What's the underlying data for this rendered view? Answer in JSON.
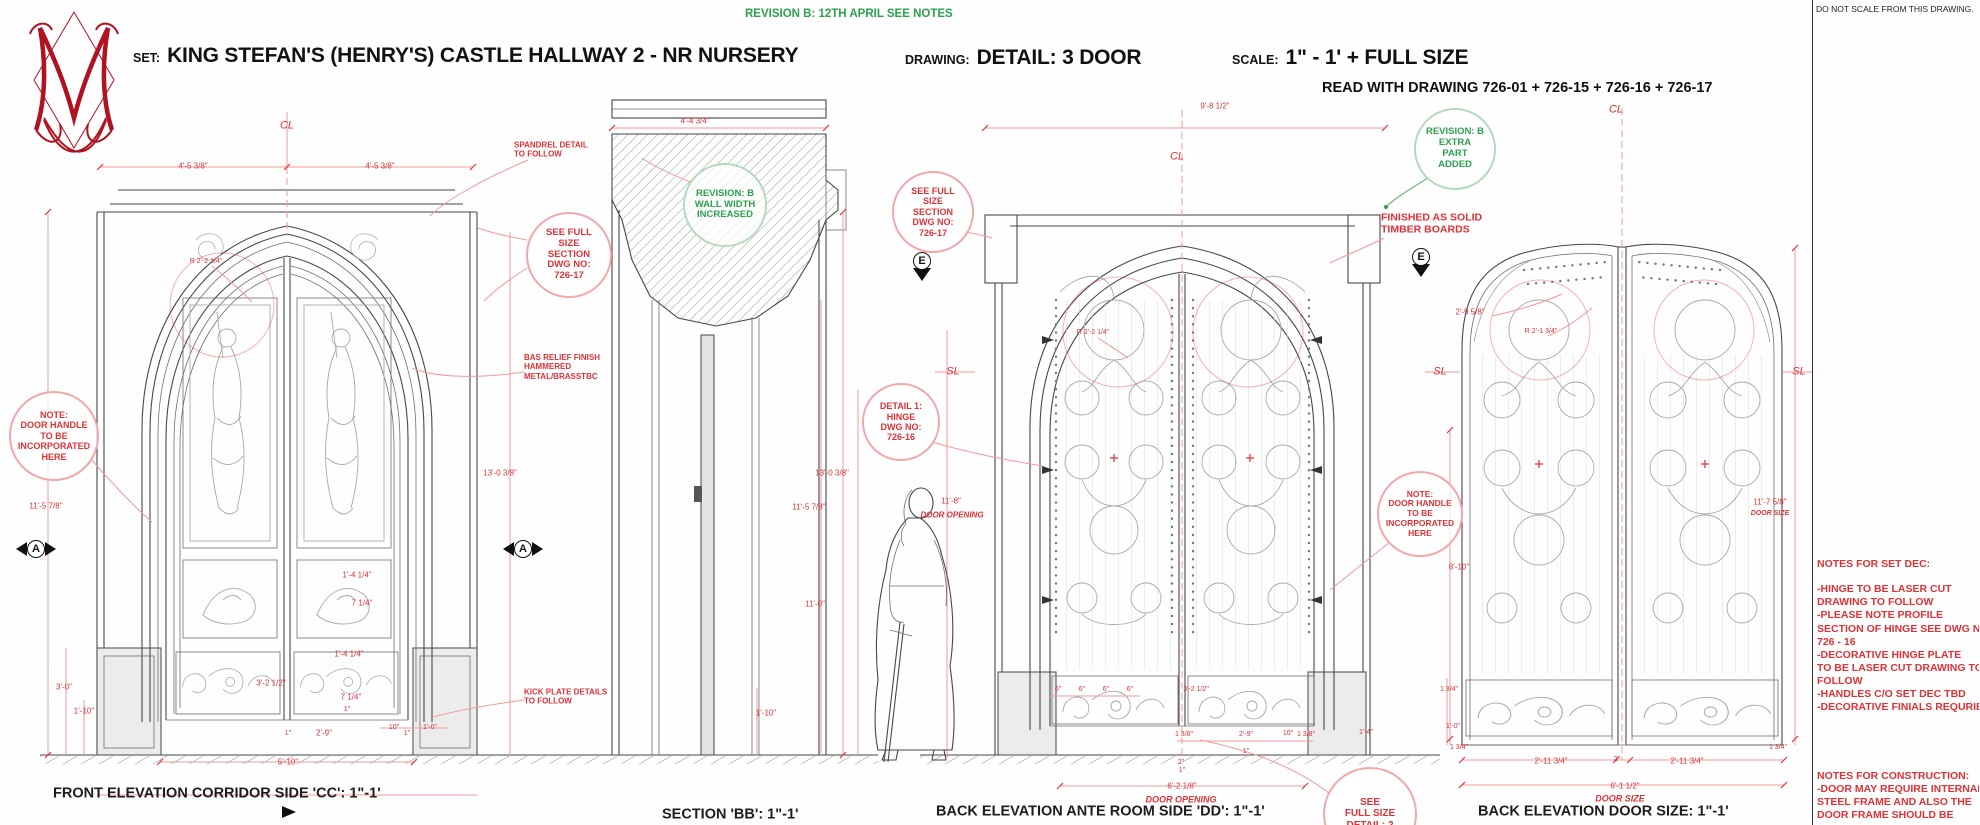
{
  "colors": {
    "red": "#de3237",
    "red_soft": "#f2a7a9",
    "green": "#2aa34c",
    "green_soft": "#b4dabb",
    "black": "#1d1d1d",
    "ink": "#474747"
  },
  "header": {
    "revision_note": "REVISION B: 12TH APRIL SEE NOTES",
    "set_label": "SET:",
    "set_value": "KING STEFAN'S (HENRY'S) CASTLE  HALLWAY 2 - NR NURSERY",
    "drawing_label": "DRAWING:",
    "drawing_value": "DETAIL: 3 DOOR",
    "scale_label": "SCALE:",
    "scale_value": "1\" - 1' + FULL SIZE",
    "read_with": "READ WITH DRAWING 726-01 + 726-15 + 726-16 + 726-17"
  },
  "logo": {
    "letter": "M"
  },
  "captions": [
    {
      "n": "do-not-scale-note",
      "t": "DO NOT SCALE FROM THIS DRAWING.",
      "x": 1816,
      "y": 9,
      "fs": 8.5,
      "c": "k",
      "al": "l"
    },
    {
      "n": "caption-front-elevation",
      "t": "FRONT ELEVATION CORRIDOR SIDE 'CC': 1\"-1'",
      "x": 53,
      "y": 794,
      "fs": 14.5,
      "c": "k",
      "b": 1,
      "al": "l"
    },
    {
      "n": "caption-section-bb",
      "t": "SECTION 'BB': 1\"-1'",
      "x": 662,
      "y": 815,
      "fs": 14.5,
      "c": "k",
      "b": 1,
      "al": "l"
    },
    {
      "n": "caption-back-elevation-dd",
      "t": "BACK ELEVATION ANTE ROOM SIDE 'DD': 1\"-1'",
      "x": 936,
      "y": 812,
      "fs": 14.5,
      "c": "k",
      "b": 1,
      "al": "l"
    },
    {
      "n": "caption-back-elevation-door-size",
      "t": "BACK ELEVATION DOOR SIZE: 1\"-1'",
      "x": 1478,
      "y": 812,
      "fs": 14.5,
      "c": "k",
      "b": 1,
      "al": "l"
    }
  ],
  "labels": [
    {
      "t": "CL",
      "x": 287,
      "y": 126,
      "fs": 11,
      "i": 1
    },
    {
      "t": "4'-5 3/8\"",
      "x": 193,
      "y": 166
    },
    {
      "t": "4'-5 3/8\"",
      "x": 380,
      "y": 166
    },
    {
      "n": "spandrel-note",
      "t": "SPANDREL DETAIL\nTO FOLLOW",
      "x": 514,
      "y": 150,
      "b": 1,
      "al": "l"
    },
    {
      "t": "R 2'-2 1/4\"",
      "x": 206,
      "y": 262,
      "fs": 7
    },
    {
      "t": "11'-5 7/8\"",
      "x": 46,
      "y": 506
    },
    {
      "t": "3'-0\"",
      "x": 64,
      "y": 687
    },
    {
      "t": "1'-10\"",
      "x": 84,
      "y": 711
    },
    {
      "t": "3'-2 1/2\"",
      "x": 271,
      "y": 683
    },
    {
      "t": "1'-4 1/4\"",
      "x": 349,
      "y": 654
    },
    {
      "t": "7 1/4\"",
      "x": 351,
      "y": 697
    },
    {
      "t": "1'-4 1/4\"",
      "x": 357,
      "y": 575
    },
    {
      "t": "7 1/4\"",
      "x": 362,
      "y": 603
    },
    {
      "t": "1\"",
      "x": 347,
      "y": 710,
      "fs": 7
    },
    {
      "t": "2'-9\"",
      "x": 324,
      "y": 733
    },
    {
      "t": "10\"",
      "x": 394,
      "y": 728,
      "fs": 7
    },
    {
      "t": "1'-0\"",
      "x": 430,
      "y": 728,
      "fs": 7
    },
    {
      "t": "1\"",
      "x": 288,
      "y": 734,
      "fs": 7
    },
    {
      "t": "1\"",
      "x": 407,
      "y": 734,
      "fs": 7
    },
    {
      "t": "5'-10\"",
      "x": 288,
      "y": 762
    },
    {
      "t": "13'-0 3/8\"",
      "x": 500,
      "y": 473
    },
    {
      "n": "bas-relief-note",
      "t": "BAS RELIEF FINISH\nHAMMERED\nMETAL/BRASSTBC",
      "x": 524,
      "y": 367,
      "b": 1,
      "al": "l"
    },
    {
      "n": "kick-plate-note",
      "t": "KICK PLATE DETAILS\nTO FOLLOW",
      "x": 524,
      "y": 697,
      "b": 1,
      "al": "l"
    },
    {
      "t": "4'-4 3/4\"",
      "x": 695,
      "y": 121
    },
    {
      "t": "13'-0 3/8\"",
      "x": 832,
      "y": 473
    },
    {
      "t": "11'-5 7/8\"",
      "x": 809,
      "y": 507
    },
    {
      "t": "11'-0\"",
      "x": 815,
      "y": 604
    },
    {
      "t": "1'-10\"",
      "x": 766,
      "y": 713
    },
    {
      "t": "9'-8 1/2\"",
      "x": 1215,
      "y": 106
    },
    {
      "t": "CL",
      "x": 1177,
      "y": 157,
      "fs": 11,
      "i": 1
    },
    {
      "t": "CL",
      "x": 1616,
      "y": 110,
      "fs": 11,
      "i": 1
    },
    {
      "t": "SL",
      "x": 953,
      "y": 372,
      "fs": 11,
      "i": 1
    },
    {
      "t": "SL",
      "x": 1440,
      "y": 372,
      "fs": 11,
      "i": 1
    },
    {
      "t": "SL",
      "x": 1799,
      "y": 372,
      "fs": 11,
      "i": 1
    },
    {
      "t": "R 2'-2 1/4\"",
      "x": 1093,
      "y": 333,
      "fs": 7
    },
    {
      "t": "R 2'-1 3/4\"",
      "x": 1541,
      "y": 332,
      "fs": 7
    },
    {
      "t": "11'-8\"",
      "x": 951,
      "y": 501
    },
    {
      "t": "DOOR OPENING",
      "x": 952,
      "y": 515,
      "i": 1,
      "b": 1
    },
    {
      "n": "timber-boards-note",
      "t": "FINISHED AS SOLID\nTIMBER BOARDS",
      "x": 1381,
      "y": 224,
      "fs": 10.5,
      "b": 1,
      "al": "l"
    },
    {
      "t": "6\"",
      "x": 1058,
      "y": 690,
      "fs": 7
    },
    {
      "t": "6\"",
      "x": 1082,
      "y": 690,
      "fs": 7
    },
    {
      "t": "6\"",
      "x": 1106,
      "y": 690,
      "fs": 7
    },
    {
      "t": "6\"",
      "x": 1130,
      "y": 690,
      "fs": 7
    },
    {
      "t": "3'-2 1/2\"",
      "x": 1196,
      "y": 690,
      "fs": 7
    },
    {
      "t": "1 3/8\"",
      "x": 1184,
      "y": 735,
      "fs": 7
    },
    {
      "t": "2'-9\"",
      "x": 1246,
      "y": 735,
      "fs": 7
    },
    {
      "t": "10\"",
      "x": 1288,
      "y": 734,
      "fs": 7
    },
    {
      "t": "1 3/8\"",
      "x": 1306,
      "y": 735,
      "fs": 7
    },
    {
      "t": "1\"",
      "x": 1246,
      "y": 752,
      "fs": 7
    },
    {
      "t": "2\"",
      "x": 1181,
      "y": 763,
      "fs": 7
    },
    {
      "t": "1\"",
      "x": 1182,
      "y": 771,
      "fs": 7
    },
    {
      "t": "6'-2 1/8\"",
      "x": 1182,
      "y": 786
    },
    {
      "t": "DOOR OPENING",
      "x": 1181,
      "y": 800,
      "fs": 9,
      "i": 1,
      "b": 1
    },
    {
      "t": "1'-4\"",
      "x": 1366,
      "y": 733,
      "fs": 7
    },
    {
      "t": "2'-9 5/8\"",
      "x": 1470,
      "y": 312
    },
    {
      "t": "8'-10\"",
      "x": 1459,
      "y": 567
    },
    {
      "t": "11'-7 5/8\"",
      "x": 1770,
      "y": 502
    },
    {
      "t": "DOOR SIZE",
      "x": 1770,
      "y": 514,
      "fs": 7,
      "i": 1,
      "b": 1
    },
    {
      "t": "1 3/4\"",
      "x": 1449,
      "y": 690,
      "fs": 7
    },
    {
      "t": "1'-0\"",
      "x": 1453,
      "y": 727,
      "fs": 7
    },
    {
      "t": "1 3/4\"",
      "x": 1459,
      "y": 748,
      "fs": 7
    },
    {
      "t": "1 3/4\"",
      "x": 1778,
      "y": 748,
      "fs": 7
    },
    {
      "t": "2'-11 3/4\"",
      "x": 1551,
      "y": 761
    },
    {
      "t": "2\"",
      "x": 1617,
      "y": 760,
      "fs": 7
    },
    {
      "t": "2'-11 3/4\"",
      "x": 1687,
      "y": 761
    },
    {
      "t": "6'-1 1/2\"",
      "x": 1625,
      "y": 786
    },
    {
      "t": "DOOR SIZE",
      "x": 1620,
      "y": 799,
      "fs": 9,
      "i": 1,
      "b": 1
    }
  ],
  "bubbles": [
    {
      "n": "see-full-size-section-bubble",
      "x": 567,
      "y": 253,
      "r": 41,
      "c": "red",
      "fs": 9.5,
      "t": "SEE FULL\nSIZE\nSECTION\nDWG NO:\n726-17"
    },
    {
      "n": "revision-wall-width-bubble",
      "x": 723,
      "y": 203,
      "r": 40,
      "c": "green",
      "fs": 9.5,
      "t": "REVISION: B\nWALL WIDTH\nINCREASED"
    },
    {
      "n": "door-handle-note-bubble-left",
      "x": 52,
      "y": 434,
      "r": 43,
      "c": "red",
      "fs": 9,
      "t": "NOTE:\nDOOR HANDLE\nTO BE\nINCORPORATED\nHERE"
    },
    {
      "n": "see-full-size-section-bubble-2",
      "x": 931,
      "y": 210,
      "r": 39,
      "c": "red",
      "fs": 9,
      "t": "SEE FULL\nSIZE\nSECTION\nDWG NO:\n726-17"
    },
    {
      "n": "detail-1-hinge-bubble",
      "x": 899,
      "y": 420,
      "r": 37,
      "c": "red",
      "fs": 9,
      "t": "DETAIL 1:\nHINGE\nDWG NO:\n726-16"
    },
    {
      "n": "revision-extra-part-bubble",
      "x": 1453,
      "y": 147,
      "r": 39,
      "c": "green",
      "fs": 9.5,
      "t": "REVISION: B\nEXTRA\nPART\nADDED"
    },
    {
      "n": "door-handle-note-bubble-right",
      "x": 1418,
      "y": 512,
      "r": 41,
      "c": "red",
      "fs": 8.5,
      "t": "NOTE:\nDOOR HANDLE\nTO BE\nINCORPORATED\nHERE"
    },
    {
      "n": "see-full-size-detail-2-bubble",
      "x": 1368,
      "y": 812,
      "r": 45,
      "c": "red",
      "fs": 10,
      "t": "SEE\nFULL SIZE\nDETAIL: 2"
    }
  ],
  "markers": [
    {
      "n": "section-marker-a-left",
      "l": "A",
      "x": 36,
      "y": 549,
      "type": "a"
    },
    {
      "n": "section-marker-a-right",
      "l": "A",
      "x": 523,
      "y": 549,
      "type": "a"
    },
    {
      "n": "section-marker-e-left",
      "l": "E",
      "x": 922,
      "y": 261,
      "type": "e"
    },
    {
      "n": "section-marker-e-right",
      "l": "E",
      "x": 1421,
      "y": 257,
      "type": "e"
    }
  ],
  "notes": {
    "set_dec": {
      "title": "NOTES FOR SET DEC:",
      "lines": [
        "-HINGE TO BE LASER CUT",
        " DRAWING TO FOLLOW",
        "-PLEASE NOTE PROFILE",
        " SECTION OF HINGE SEE DWG NO:",
        " 726 - 16",
        "-DECORATIVE HINGE PLATE",
        " TO BE LASER CUT DRAWING TO",
        " FOLLOW",
        "-HANDLES C/O SET DEC TBD",
        "-DECORATIVE FINIALS REQURIED"
      ]
    },
    "construction": {
      "title": "NOTES FOR CONSTRUCTION:",
      "lines": [
        "-DOOR MAY REQUIRE INTERNAL",
        " STEEL FRAME AND ALSO THE",
        " DOOR FRAME SHOULD BE",
        " SUBSTANTIAL ENOUGH TO"
      ]
    }
  }
}
